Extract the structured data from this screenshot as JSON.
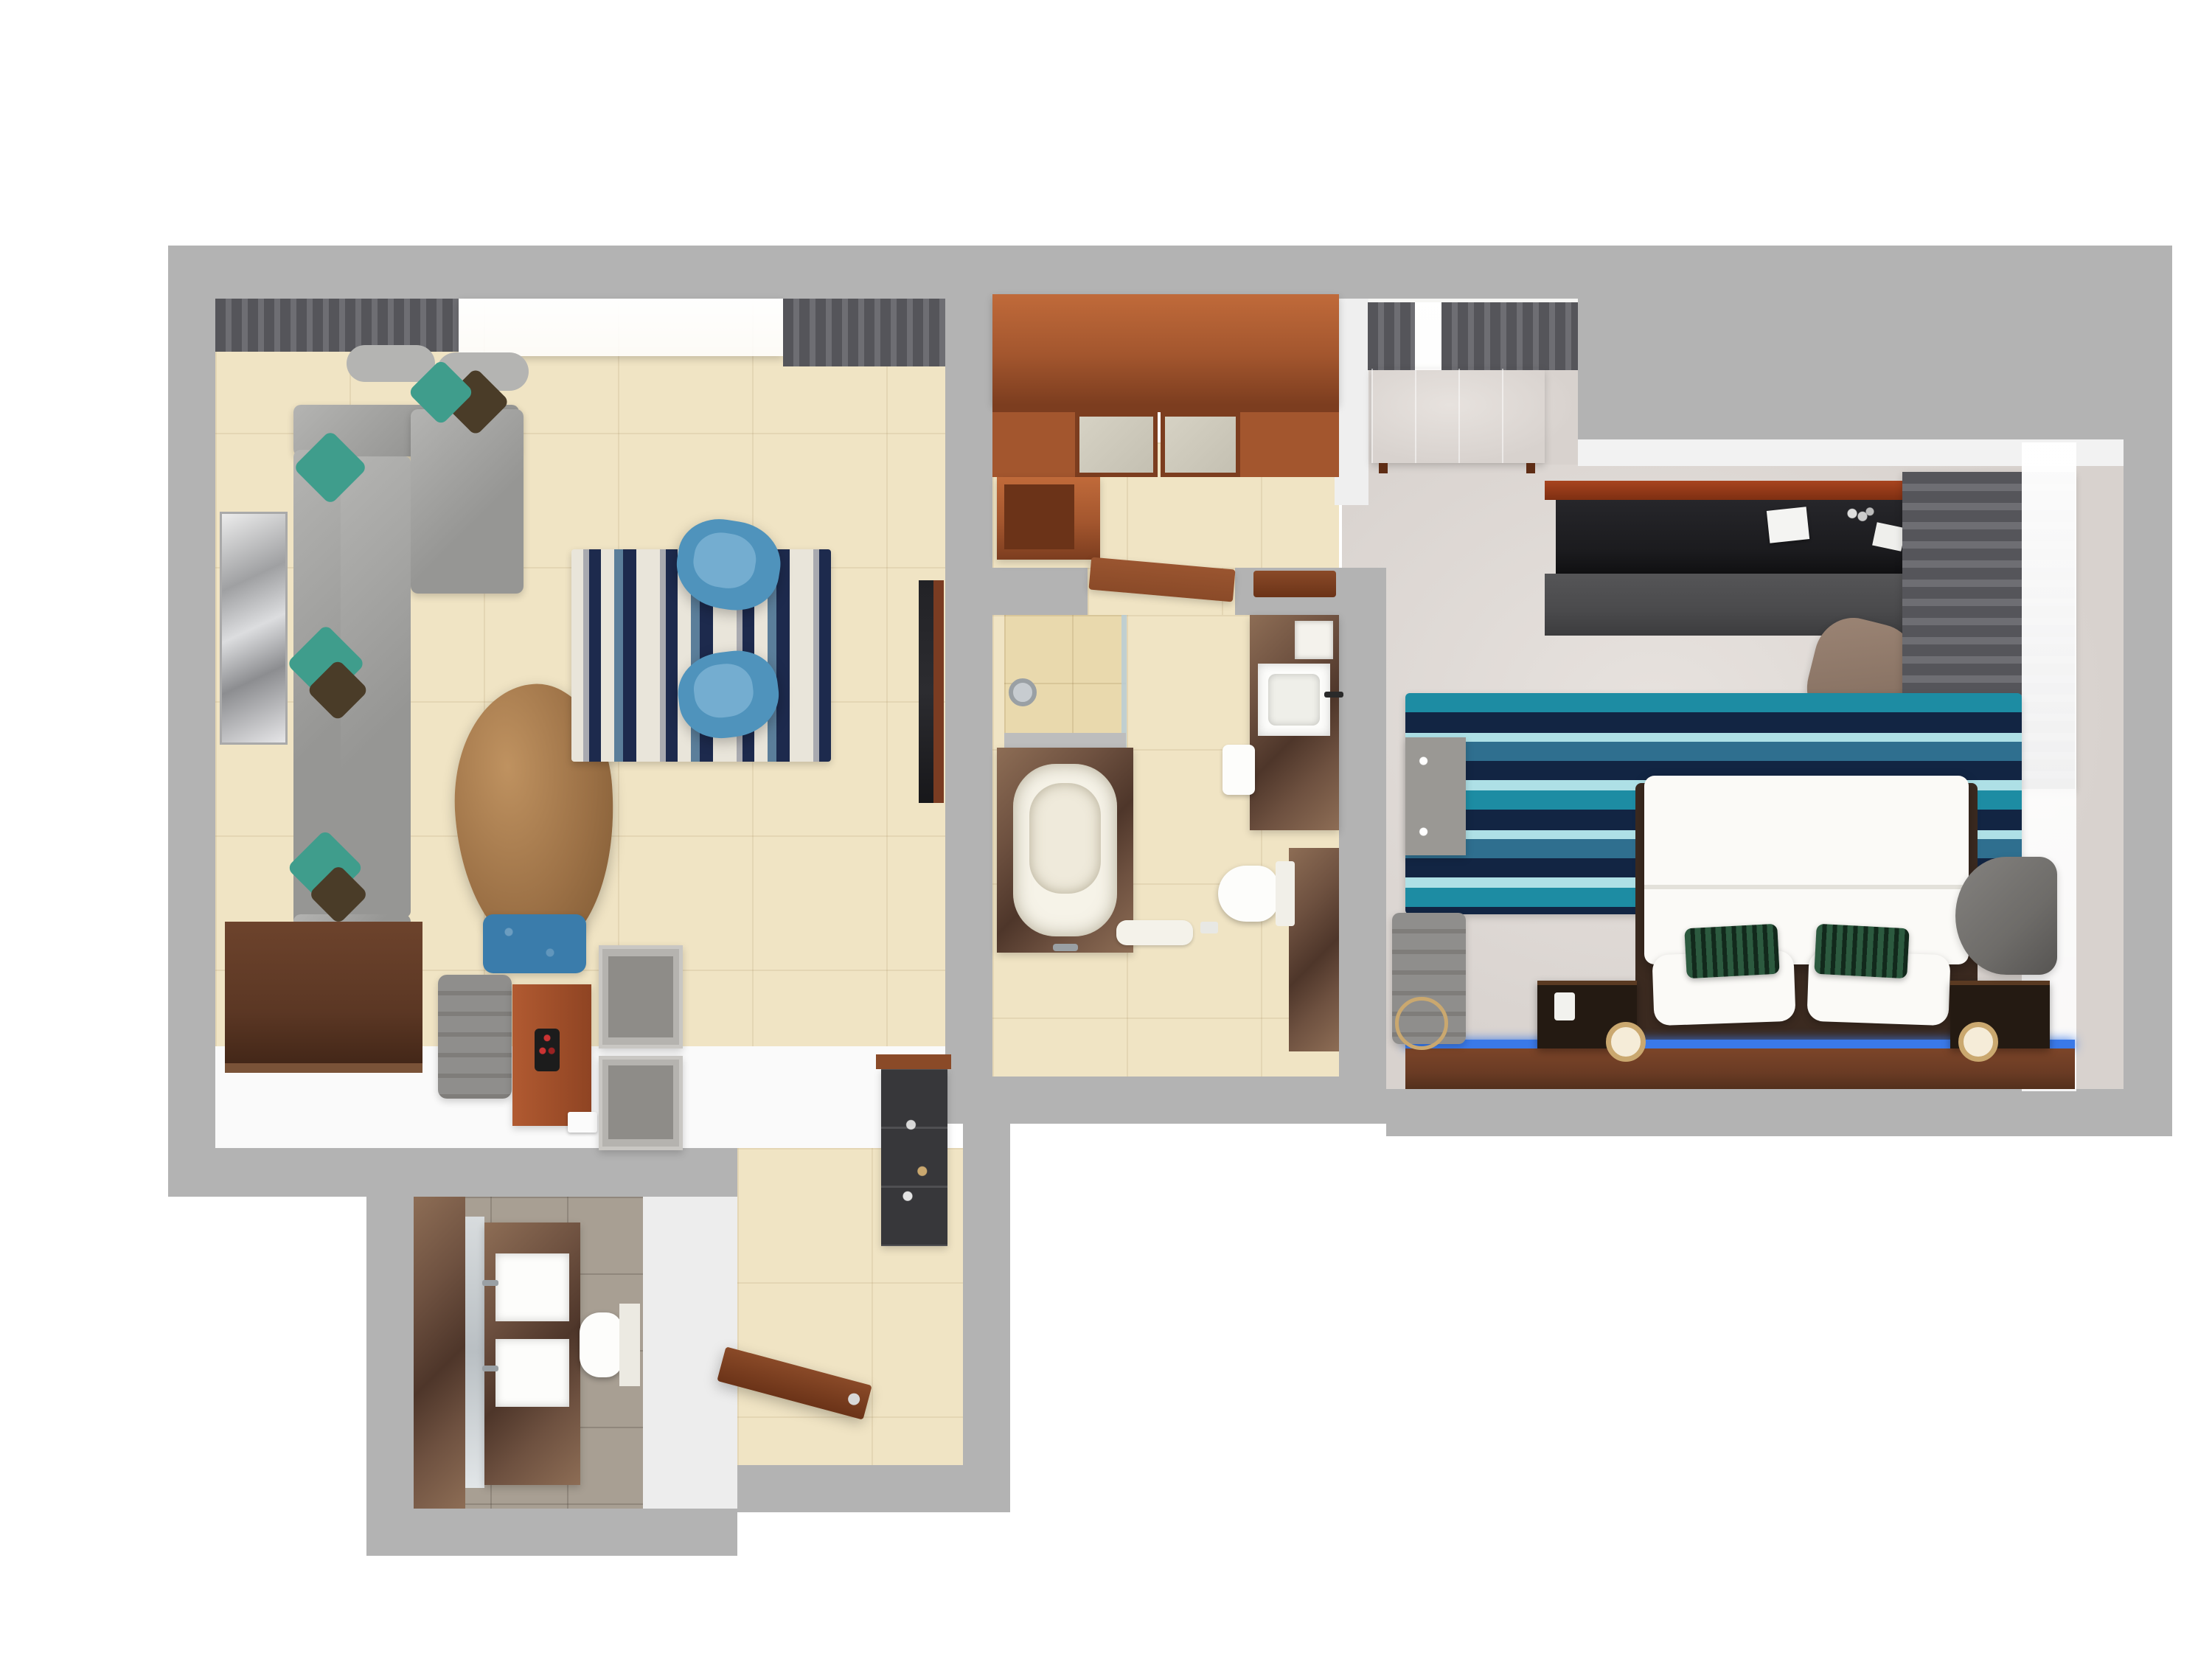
{
  "scene": {
    "type": "3d-floor-plan-top-view",
    "description": "Top-down 3D render of a one-bedroom hotel suite",
    "rooms": [
      {
        "id": "living-room",
        "semantic": "living-room",
        "floor": "beige ceramic tile",
        "furniture": [
          "l-shaped-gray-sectional-sofa",
          "teal-and-leopard-accent-pillows",
          "geometric-wall-mirror",
          "pebble-wood-coffee-table",
          "ikat-stripe-area-rug",
          "blue-swivel-armchair-top",
          "blue-swivel-armchair-bottom",
          "blue-tufted-ottoman",
          "wall-mounted-tv",
          "wall-mounted-console-panel",
          "gray-upholstered-bench",
          "wood-dressing-panel",
          "luggage-rack-top",
          "luggage-rack-bottom",
          "window-sheer-curtain",
          "gray-drapes"
        ]
      },
      {
        "id": "foyer",
        "semantic": "entry-foyer-closet",
        "floor": "beige ceramic tile",
        "furniture": [
          "wardrobe-closet-frosted-sliding-doors",
          "open-storage-cabinet",
          "bathroom-door-open",
          "wood-wall-shelf"
        ]
      },
      {
        "id": "main-bathroom",
        "semantic": "main-bathroom",
        "floor": "beige ceramic tile",
        "furniture": [
          "walk-in-shower-glass",
          "half-wall",
          "marble-bathtub-deck",
          "white-bathtub",
          "marble-vanity-counter",
          "square-vessel-sink",
          "toilet",
          "lower-marble-counter",
          "bath-mat",
          "wall-niche"
        ]
      },
      {
        "id": "bedroom",
        "semantic": "bedroom",
        "floor": "light gray carpet",
        "furniture": [
          "red-wood-dresser",
          "striped-window-curtains",
          "work-desk-dark-top",
          "office-chair",
          "desk-papers",
          "roman-shade-curtain",
          "sheer-window-curtain",
          "blue-wave-stripe-rug",
          "king-bed-white-duvet",
          "white-pillows",
          "green-striped-accent-pillows",
          "headboard-wood-ledge",
          "led-light-strip",
          "nightstand-left",
          "nightstand-right",
          "table-lamp-left",
          "table-lamp-right",
          "telephone",
          "gray-tv-cabinet",
          "gray-lounge-bench",
          "round-wall-decor",
          "gray-barrel-armchair"
        ]
      },
      {
        "id": "corridor",
        "semantic": "entry-corridor",
        "floor": "beige ceramic tile",
        "furniture": [
          "entry-door-open",
          "minibar-cabinet",
          "minibar-wood-top"
        ]
      },
      {
        "id": "powder-room",
        "semantic": "second-bathroom",
        "floor": "gray stone tile",
        "furniture": [
          "marble-accent-wall",
          "vanity-mirror",
          "marble-vanity",
          "square-sink-top",
          "square-sink-bottom",
          "toilet"
        ]
      }
    ]
  },
  "palette": {
    "outside": "#ffffff",
    "wall": "#b3b3b3",
    "cut": "#f2f2f2",
    "tile": "#f0e4c4",
    "tile_dark": "#e9d9ad",
    "carpet": "#d8d2ce",
    "carpet_light": "#e7e2de",
    "powder_floor": "#a89f93",
    "wood": "#a3562e",
    "wood_light": "#c06a3a",
    "wood_dark": "#7c3d1f",
    "door_wood": "#8a4a28",
    "marble": "#6e5140",
    "marble_light": "#8d6d55",
    "marble_dark": "#4e362a",
    "sofa": "#969694",
    "sofa_light": "#b4b4b2",
    "pillow_teal": "#3f9d8c",
    "pillow_leopard": "#4a3c28",
    "rug_cream": "#e9e5da",
    "rug_gray": "#a9aab0",
    "rug_navy": "#1d2a4d",
    "rug_blue": "#5b7e9a",
    "rug2_teal": "#1d8ca3",
    "rug2_navy": "#122543",
    "rug2_light": "#aee0e6",
    "rug2_mid": "#2f6f8f",
    "chair_blue": "#4f93bc",
    "chair_blue_light": "#74add0",
    "ottoman_blue": "#3a7cab",
    "table_wood": "#9c7146",
    "table_wood_dark": "#7a5530",
    "tv_dark": "#2c2c30",
    "console_wood": "#5b3724",
    "bench_gray": "#8f8e8c",
    "luggage_gray": "#b5b3af",
    "luggage_inner": "#8e8c88",
    "curtain_dark": "#55555a",
    "curtain_mid": "#6e6e73",
    "bed_white": "#fbfaf7",
    "green_pillow": "#2c5a3f",
    "green_pillow_dark": "#12291c",
    "headboard_wood": "#6a3b24",
    "led_blue": "#3a79e8",
    "nightstand_dark": "#241a12",
    "lamp_gold": "#caa86f",
    "dresser_wood": "#9e4f2c",
    "desk_black": "#1b1b1e",
    "desk_front": "#4a4a4c",
    "chair_brown": "#8a7465",
    "cabinet_gray": "#9a9894",
    "armchair_gray": "#6e6c69",
    "minibar_dark": "#37373a",
    "tub_white": "#f6f3e8",
    "glass": "#b9cdd6",
    "white_fixture": "#fdfdfb",
    "shade_gray": "#5d5d60"
  }
}
